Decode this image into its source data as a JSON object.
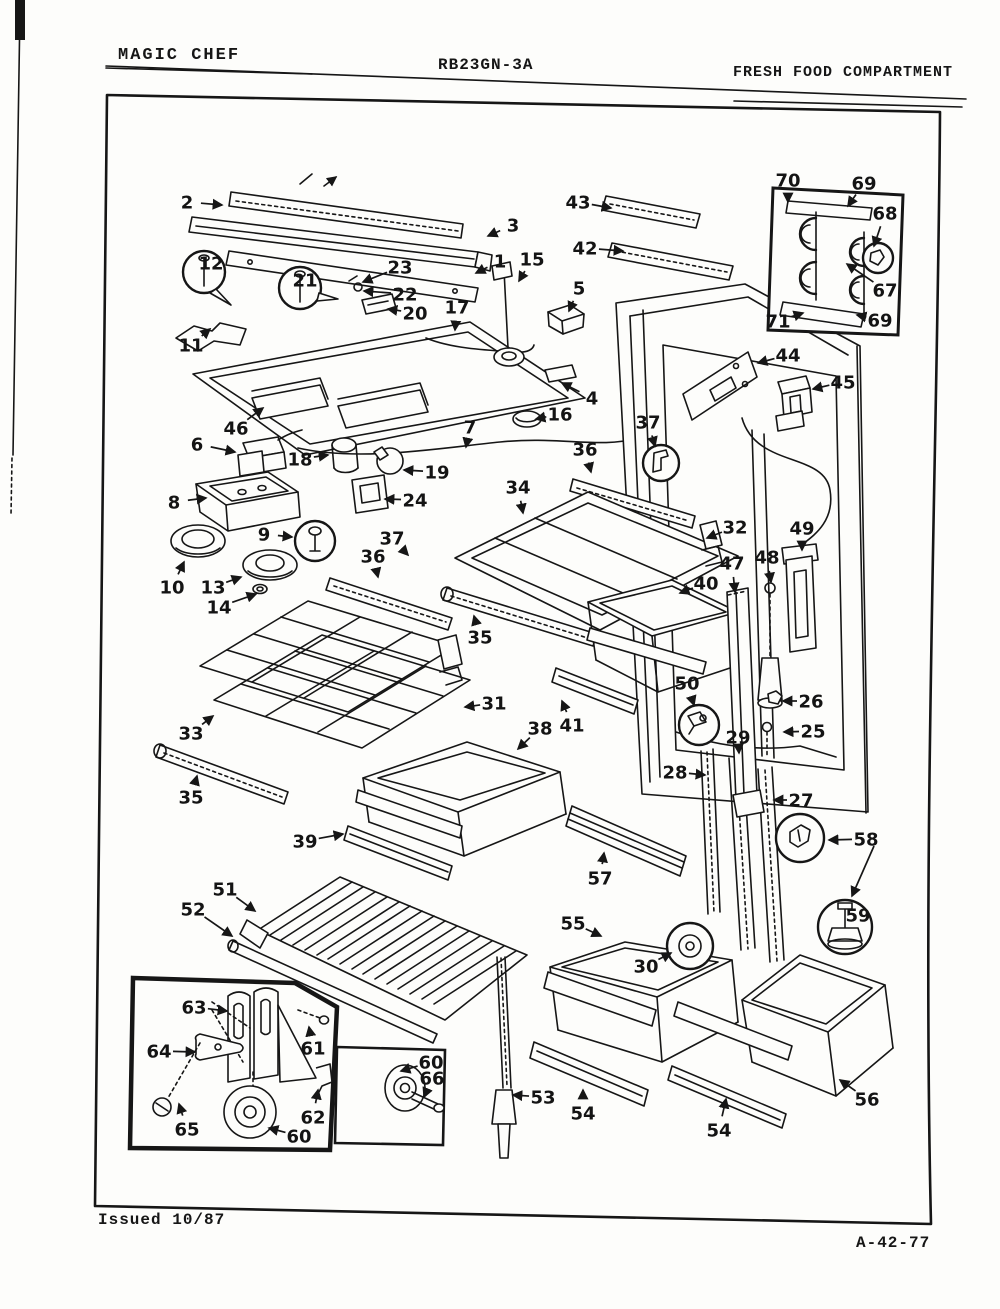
{
  "header": {
    "brand": "MAGIC CHEF",
    "model": "RB23GN-3A",
    "section": "FRESH FOOD COMPARTMENT"
  },
  "footer": {
    "issued": "Issued 10/87",
    "doc_number": "A-42-77"
  },
  "diagram": {
    "type": "exploded-parts-diagram",
    "subject": "Refrigerator fresh food compartment exploded view with numbered part callouts",
    "callouts": [
      {
        "label": "1",
        "x": 500,
        "y": 261,
        "tx": 476,
        "ty": 273
      },
      {
        "label": "2",
        "x": 187,
        "y": 202,
        "tx": 222,
        "ty": 205
      },
      {
        "label": "3",
        "x": 513,
        "y": 225,
        "tx": 488,
        "ty": 236
      },
      {
        "label": "4",
        "x": 592,
        "y": 398,
        "tx": 562,
        "ty": 383
      },
      {
        "label": "5",
        "x": 579,
        "y": 288,
        "tx": 569,
        "ty": 311
      },
      {
        "label": "6",
        "x": 197,
        "y": 444,
        "tx": 235,
        "ty": 452
      },
      {
        "label": "7",
        "x": 470,
        "y": 427,
        "tx": 466,
        "ty": 447
      },
      {
        "label": "8",
        "x": 174,
        "y": 502,
        "tx": 206,
        "ty": 498
      },
      {
        "label": "9",
        "x": 264,
        "y": 534,
        "tx": 292,
        "ty": 537
      },
      {
        "label": "10",
        "x": 172,
        "y": 587,
        "tx": 184,
        "ty": 562
      },
      {
        "label": "11",
        "x": 191,
        "y": 345,
        "tx": 210,
        "ty": 329
      },
      {
        "label": "12",
        "x": 211,
        "y": 263,
        "circled": true
      },
      {
        "label": "13",
        "x": 213,
        "y": 587,
        "tx": 241,
        "ty": 577
      },
      {
        "label": "14",
        "x": 219,
        "y": 607,
        "tx": 256,
        "ty": 594
      },
      {
        "label": "15",
        "x": 532,
        "y": 259,
        "tx": 519,
        "ty": 281
      },
      {
        "label": "16",
        "x": 560,
        "y": 414,
        "tx": 536,
        "ty": 419
      },
      {
        "label": "17",
        "x": 457,
        "y": 307,
        "tx": 455,
        "ty": 330
      },
      {
        "label": "18",
        "x": 300,
        "y": 459,
        "tx": 328,
        "ty": 455
      },
      {
        "label": "19",
        "x": 437,
        "y": 472,
        "tx": 404,
        "ty": 470
      },
      {
        "label": "20",
        "x": 415,
        "y": 313,
        "tx": 388,
        "ty": 309
      },
      {
        "label": "21",
        "x": 305,
        "y": 280,
        "circled": true
      },
      {
        "label": "22",
        "x": 405,
        "y": 294,
        "tx": 364,
        "ty": 291
      },
      {
        "label": "23",
        "x": 400,
        "y": 267,
        "tx": 363,
        "ty": 282
      },
      {
        "label": "24",
        "x": 415,
        "y": 500,
        "tx": 385,
        "ty": 499
      },
      {
        "label": "25",
        "x": 813,
        "y": 731,
        "tx": 784,
        "ty": 732
      },
      {
        "label": "26",
        "x": 811,
        "y": 701,
        "tx": 783,
        "ty": 701
      },
      {
        "label": "27",
        "x": 801,
        "y": 800,
        "tx": 774,
        "ty": 800
      },
      {
        "label": "28",
        "x": 675,
        "y": 772,
        "tx": 705,
        "ty": 775
      },
      {
        "label": "29",
        "x": 738,
        "y": 737,
        "tx": 739,
        "ty": 753
      },
      {
        "label": "30",
        "x": 646,
        "y": 966,
        "tx": 671,
        "ty": 953
      },
      {
        "label": "31",
        "x": 494,
        "y": 703,
        "tx": 465,
        "ty": 707
      },
      {
        "label": "32",
        "x": 735,
        "y": 527,
        "tx": 707,
        "ty": 538
      },
      {
        "label": "33",
        "x": 191,
        "y": 733,
        "tx": 213,
        "ty": 716
      },
      {
        "label": "34",
        "x": 518,
        "y": 487,
        "tx": 523,
        "ty": 513
      },
      {
        "label": "35",
        "x": 480,
        "y": 637,
        "tx": 474,
        "ty": 616
      },
      {
        "label": "35",
        "x": 191,
        "y": 797,
        "tx": 197,
        "ty": 776
      },
      {
        "label": "36",
        "x": 373,
        "y": 556,
        "tx": 378,
        "ty": 577
      },
      {
        "label": "36",
        "x": 585,
        "y": 449,
        "tx": 591,
        "ty": 472
      },
      {
        "label": "37",
        "x": 392,
        "y": 538,
        "tx": 408,
        "ty": 555
      },
      {
        "label": "37",
        "x": 648,
        "y": 422,
        "tx": 655,
        "ty": 446
      },
      {
        "label": "38",
        "x": 540,
        "y": 728,
        "tx": 518,
        "ty": 749
      },
      {
        "label": "39",
        "x": 305,
        "y": 841,
        "tx": 343,
        "ty": 834
      },
      {
        "label": "40",
        "x": 706,
        "y": 583,
        "tx": 680,
        "ty": 593
      },
      {
        "label": "41",
        "x": 572,
        "y": 725,
        "tx": 562,
        "ty": 701
      },
      {
        "label": "42",
        "x": 585,
        "y": 248,
        "tx": 623,
        "ty": 251
      },
      {
        "label": "43",
        "x": 578,
        "y": 202,
        "tx": 611,
        "ty": 208
      },
      {
        "label": "44",
        "x": 788,
        "y": 355,
        "tx": 758,
        "ty": 363
      },
      {
        "label": "45",
        "x": 843,
        "y": 382,
        "tx": 813,
        "ty": 389
      },
      {
        "label": "46",
        "x": 236,
        "y": 428,
        "tx": 263,
        "ty": 408
      },
      {
        "label": "47",
        "x": 732,
        "y": 563,
        "tx": 735,
        "ty": 592
      },
      {
        "label": "48",
        "x": 767,
        "y": 557,
        "tx": 771,
        "ty": 582
      },
      {
        "label": "49",
        "x": 802,
        "y": 528,
        "tx": 802,
        "ty": 550
      },
      {
        "label": "50",
        "x": 687,
        "y": 683,
        "tx": 694,
        "ty": 705
      },
      {
        "label": "51",
        "x": 225,
        "y": 889,
        "tx": 255,
        "ty": 911
      },
      {
        "label": "52",
        "x": 193,
        "y": 909,
        "tx": 232,
        "ty": 936
      },
      {
        "label": "53",
        "x": 543,
        "y": 1097,
        "tx": 513,
        "ty": 1095
      },
      {
        "label": "54",
        "x": 583,
        "y": 1113,
        "tx": 583,
        "ty": 1090
      },
      {
        "label": "54",
        "x": 719,
        "y": 1130,
        "tx": 726,
        "ty": 1099
      },
      {
        "label": "55",
        "x": 573,
        "y": 923,
        "tx": 601,
        "ty": 936
      },
      {
        "label": "56",
        "x": 867,
        "y": 1099,
        "tx": 840,
        "ty": 1080
      },
      {
        "label": "57",
        "x": 600,
        "y": 878,
        "tx": 604,
        "ty": 853
      },
      {
        "label": "58",
        "x": 866,
        "y": 839,
        "tx": 829,
        "ty": 840
      },
      {
        "label": "59",
        "x": 858,
        "y": 915,
        "circled": true
      },
      {
        "label": "60",
        "x": 299,
        "y": 1136,
        "tx": 269,
        "ty": 1128
      },
      {
        "label": "60",
        "x": 431,
        "y": 1062,
        "tx": 401,
        "ty": 1071
      },
      {
        "label": "61",
        "x": 313,
        "y": 1048,
        "tx": 309,
        "ty": 1027
      },
      {
        "label": "62",
        "x": 313,
        "y": 1117,
        "tx": 318,
        "ty": 1090
      },
      {
        "label": "63",
        "x": 194,
        "y": 1007,
        "tx": 227,
        "ty": 1011
      },
      {
        "label": "64",
        "x": 159,
        "y": 1051,
        "tx": 195,
        "ty": 1052
      },
      {
        "label": "65",
        "x": 187,
        "y": 1129,
        "tx": 179,
        "ty": 1104
      },
      {
        "label": "66",
        "x": 432,
        "y": 1078,
        "tx": 424,
        "ty": 1097
      },
      {
        "label": "67",
        "x": 885,
        "y": 290,
        "tx": 847,
        "ty": 264
      },
      {
        "label": "68",
        "x": 885,
        "y": 213,
        "tx": 874,
        "ty": 246
      },
      {
        "label": "69",
        "x": 864,
        "y": 183,
        "tx": 848,
        "ty": 206
      },
      {
        "label": "69",
        "x": 880,
        "y": 320,
        "tx": 857,
        "ty": 315
      },
      {
        "label": "70",
        "x": 788,
        "y": 180,
        "tx": 788,
        "ty": 202
      },
      {
        "label": "71",
        "x": 778,
        "y": 321,
        "tx": 803,
        "ty": 313
      }
    ]
  }
}
